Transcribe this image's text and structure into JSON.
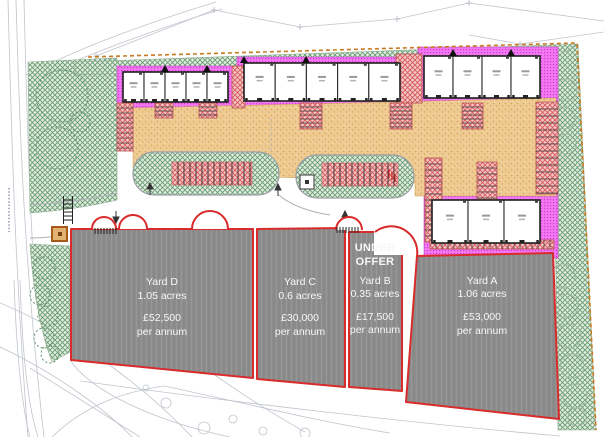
{
  "yards": [
    {
      "name": "Yard A",
      "area": "1.06 acres",
      "rent": "£53,000",
      "period": "per annum",
      "status_lines": []
    },
    {
      "name": "Yard B",
      "area": "0.35 acres",
      "rent": "£17,500",
      "period": "per annum",
      "status_lines": [
        "UNDER",
        "OFFER"
      ]
    },
    {
      "name": "Yard C",
      "area": "0.6 acres",
      "rent": "£30,000",
      "period": "per annum",
      "status_lines": []
    },
    {
      "name": "Yard D",
      "area": "1.05 acres",
      "rent": "£52,500",
      "period": "per annum",
      "status_lines": []
    }
  ],
  "colors": {
    "yard_boundary_red": "#d92b2b",
    "site_boundary_orange": "#c8791f",
    "landscape_green": "#679b72",
    "building_band_magenta": "#ee6ef0",
    "parking_hatch_red": "#d45858",
    "courtyard_sand": "#eecb92",
    "yard_gray": "#8d8d8d"
  }
}
